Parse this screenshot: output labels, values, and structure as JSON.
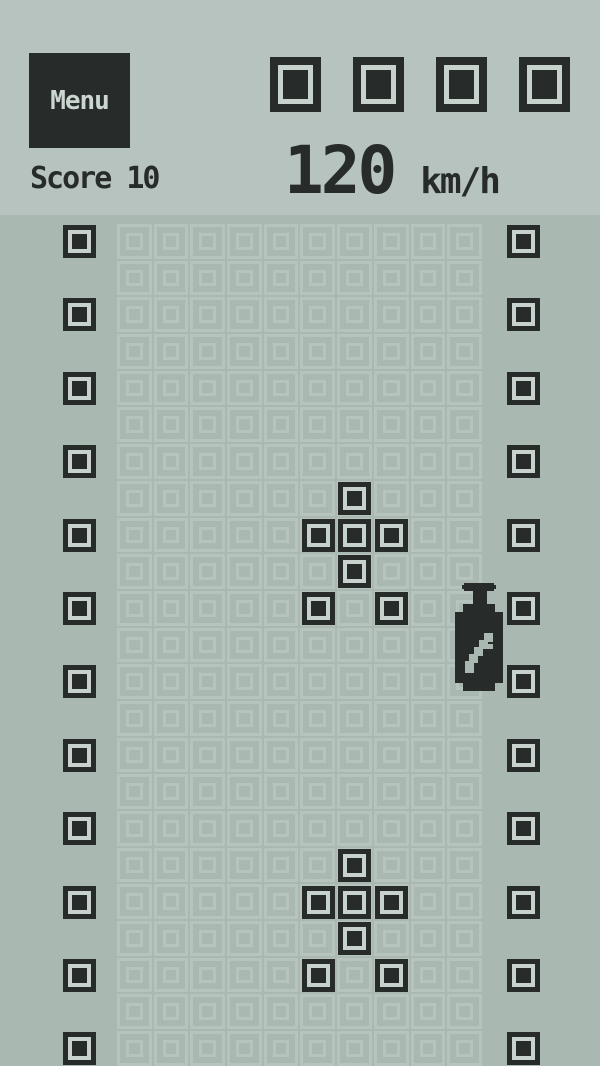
{
  "header": {
    "menu_label": "Menu",
    "score_label": "Score 10",
    "speed_value": "120",
    "speed_unit": "km/h",
    "lives_count": 4
  },
  "colors": {
    "header_bg": "#b6c3be",
    "field_bg": "#a9b8b1",
    "grid_line": "#b7c4be",
    "block_dark": "#272b2a",
    "block_light": "#c7d2cd",
    "menu_text": "#ccd6d1"
  },
  "field": {
    "columns": 10,
    "rows": 23,
    "wall_rows": [
      0,
      2,
      4,
      6,
      8,
      10,
      12,
      14,
      16,
      18,
      20,
      22
    ],
    "cars": [
      {
        "name": "car-upper",
        "cells": [
          [
            6,
            7
          ],
          [
            5,
            8
          ],
          [
            6,
            8
          ],
          [
            7,
            8
          ],
          [
            6,
            9
          ],
          [
            5,
            10
          ],
          [
            7,
            10
          ]
        ]
      },
      {
        "name": "car-lower",
        "cells": [
          [
            6,
            17
          ],
          [
            5,
            18
          ],
          [
            6,
            18
          ],
          [
            7,
            18
          ],
          [
            6,
            19
          ],
          [
            5,
            20
          ],
          [
            7,
            20
          ]
        ]
      }
    ],
    "powerup": {
      "name": "nitro-bottle",
      "x": 455,
      "y": 581
    }
  }
}
